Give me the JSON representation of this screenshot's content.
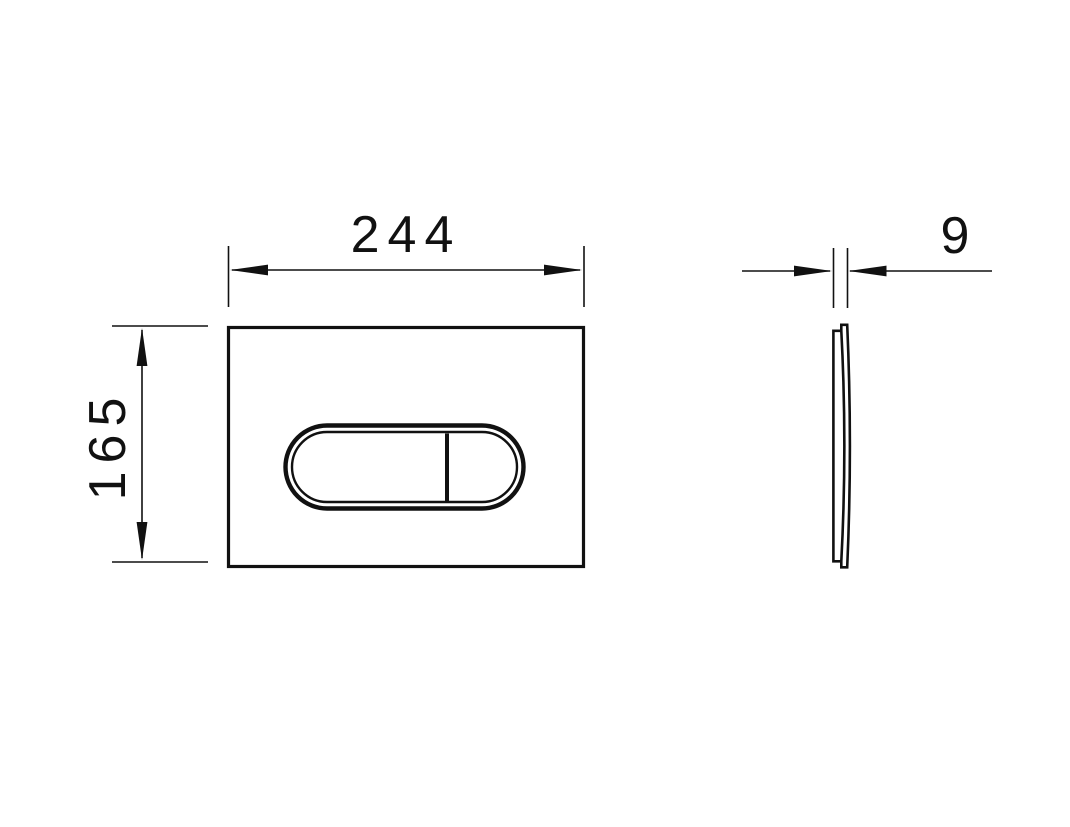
{
  "drawing": {
    "front_view": {
      "width_label": "244",
      "height_label": "165"
    },
    "side_view": {
      "depth_label": "9"
    },
    "colors": {
      "line": "#111111",
      "background": "#ffffff"
    }
  }
}
